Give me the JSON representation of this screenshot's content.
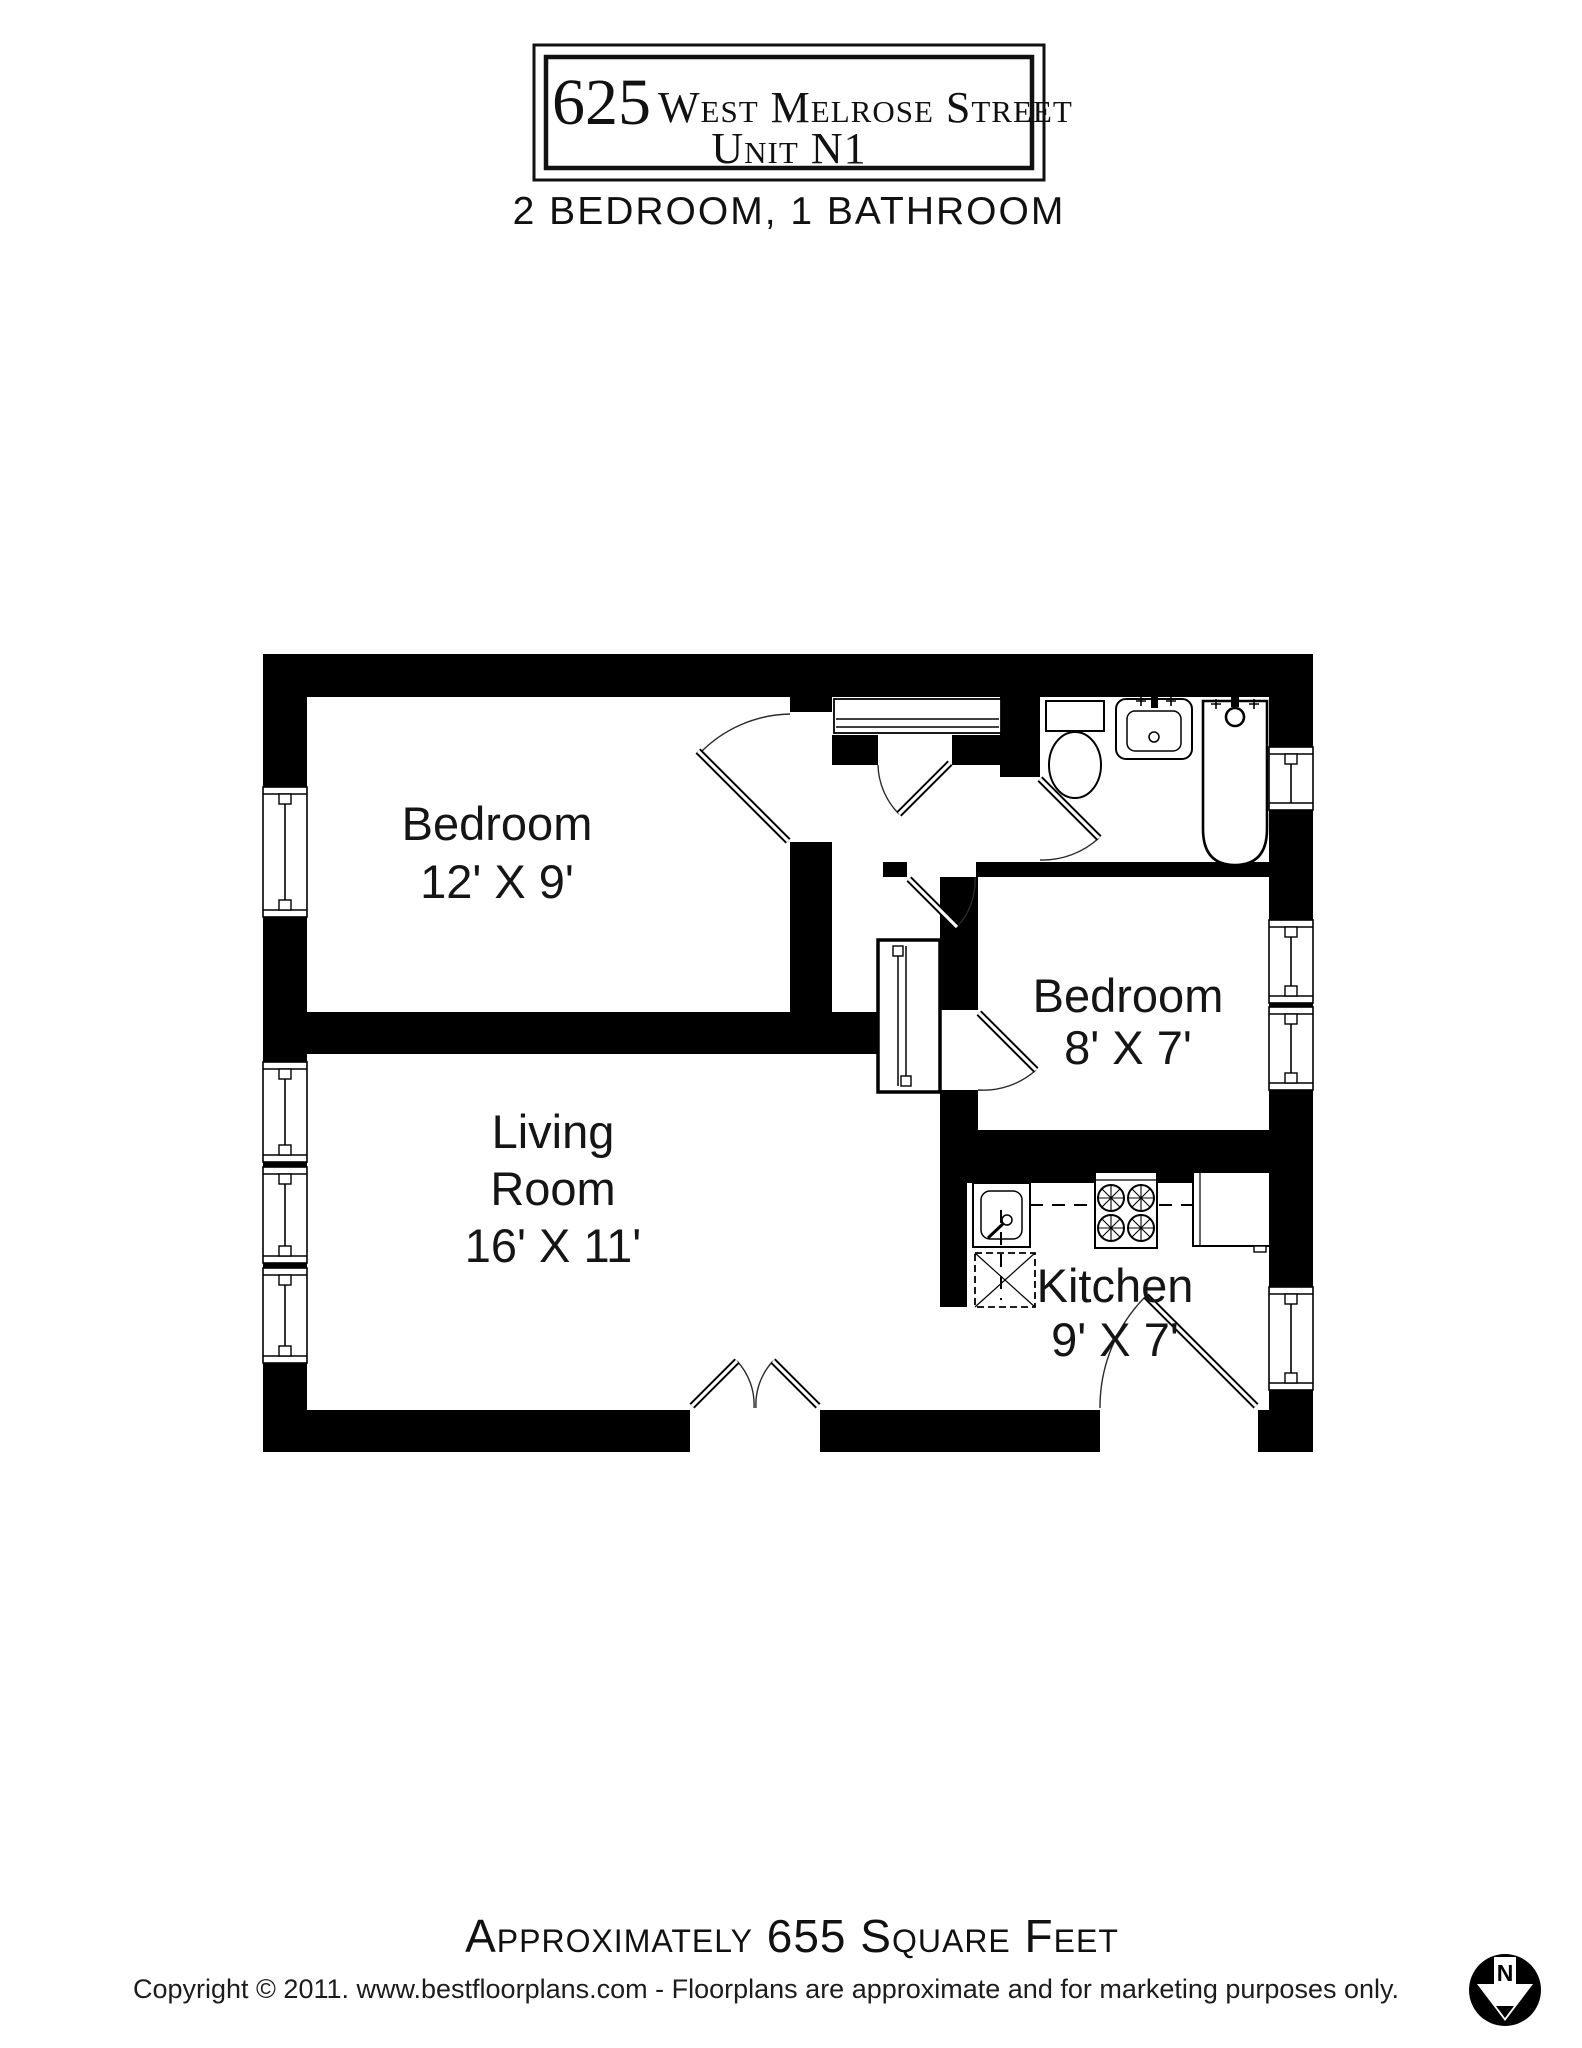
{
  "header": {
    "address_number": "625",
    "address_street": "West Melrose Street",
    "unit": "Unit N1",
    "subtitle": "2 BEDROOM, 1 BATHROOM"
  },
  "rooms": {
    "bedroom1": {
      "name": "Bedroom",
      "dims": "12' X 9'"
    },
    "bedroom2": {
      "name": "Bedroom",
      "dims": "8' X 7'"
    },
    "living": {
      "line1": "Living",
      "line2": "Room",
      "dims": "16' X 11'"
    },
    "kitchen": {
      "name": "Kitchen",
      "dims": "9' X 7'"
    }
  },
  "footer": {
    "area": "Approximately 655 Square Feet",
    "copyright": "Copyright © 2011. www.bestfloorplans.com - Floorplans are approximate and for marketing purposes only."
  },
  "compass": {
    "label": "N"
  },
  "colors": {
    "wall": "#000000",
    "background": "#ffffff",
    "text": "#151515"
  }
}
